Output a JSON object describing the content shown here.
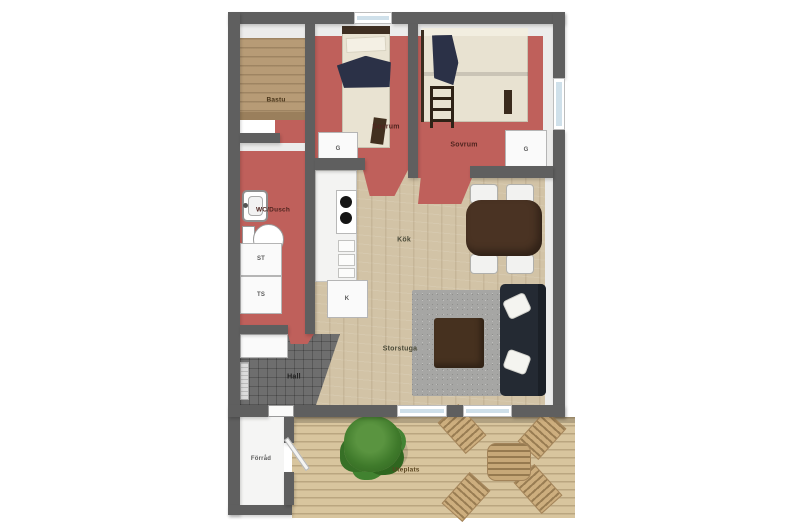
{
  "floorplan": {
    "rooms": {
      "bastu": {
        "label": "Bastu"
      },
      "wc_dusch": {
        "label": "WC/Dusch"
      },
      "sovrum_1": {
        "label": "Sovrum"
      },
      "sovrum_2": {
        "label": "Sovrum"
      },
      "kok": {
        "label": "Kök"
      },
      "storstuga": {
        "label": "Storstuga"
      },
      "hall": {
        "label": "Hall"
      },
      "forrad": {
        "label": "Förråd"
      },
      "uteplats": {
        "label": "Uteplats"
      }
    },
    "cabinets": {
      "wardrobe_left": {
        "label": "G"
      },
      "wardrobe_right": {
        "label": "G"
      },
      "st_unit": {
        "label": "ST"
      },
      "ts_unit": {
        "label": "TS"
      },
      "fridge": {
        "label": "K"
      }
    },
    "colors": {
      "wall": "#5f5f5f",
      "red_floor": "#bf605b",
      "wood_floor": "#d2c3a6",
      "tile_floor": "#6e6e6e",
      "deck": "#d8c59e",
      "sofa": "#242a33",
      "rug": "#a6a6a4",
      "bench_wood": "#b79b76",
      "table_wood": "#4a3323",
      "blanket_navy": "#2b3147",
      "plant_green": "#3f7a2b"
    }
  }
}
